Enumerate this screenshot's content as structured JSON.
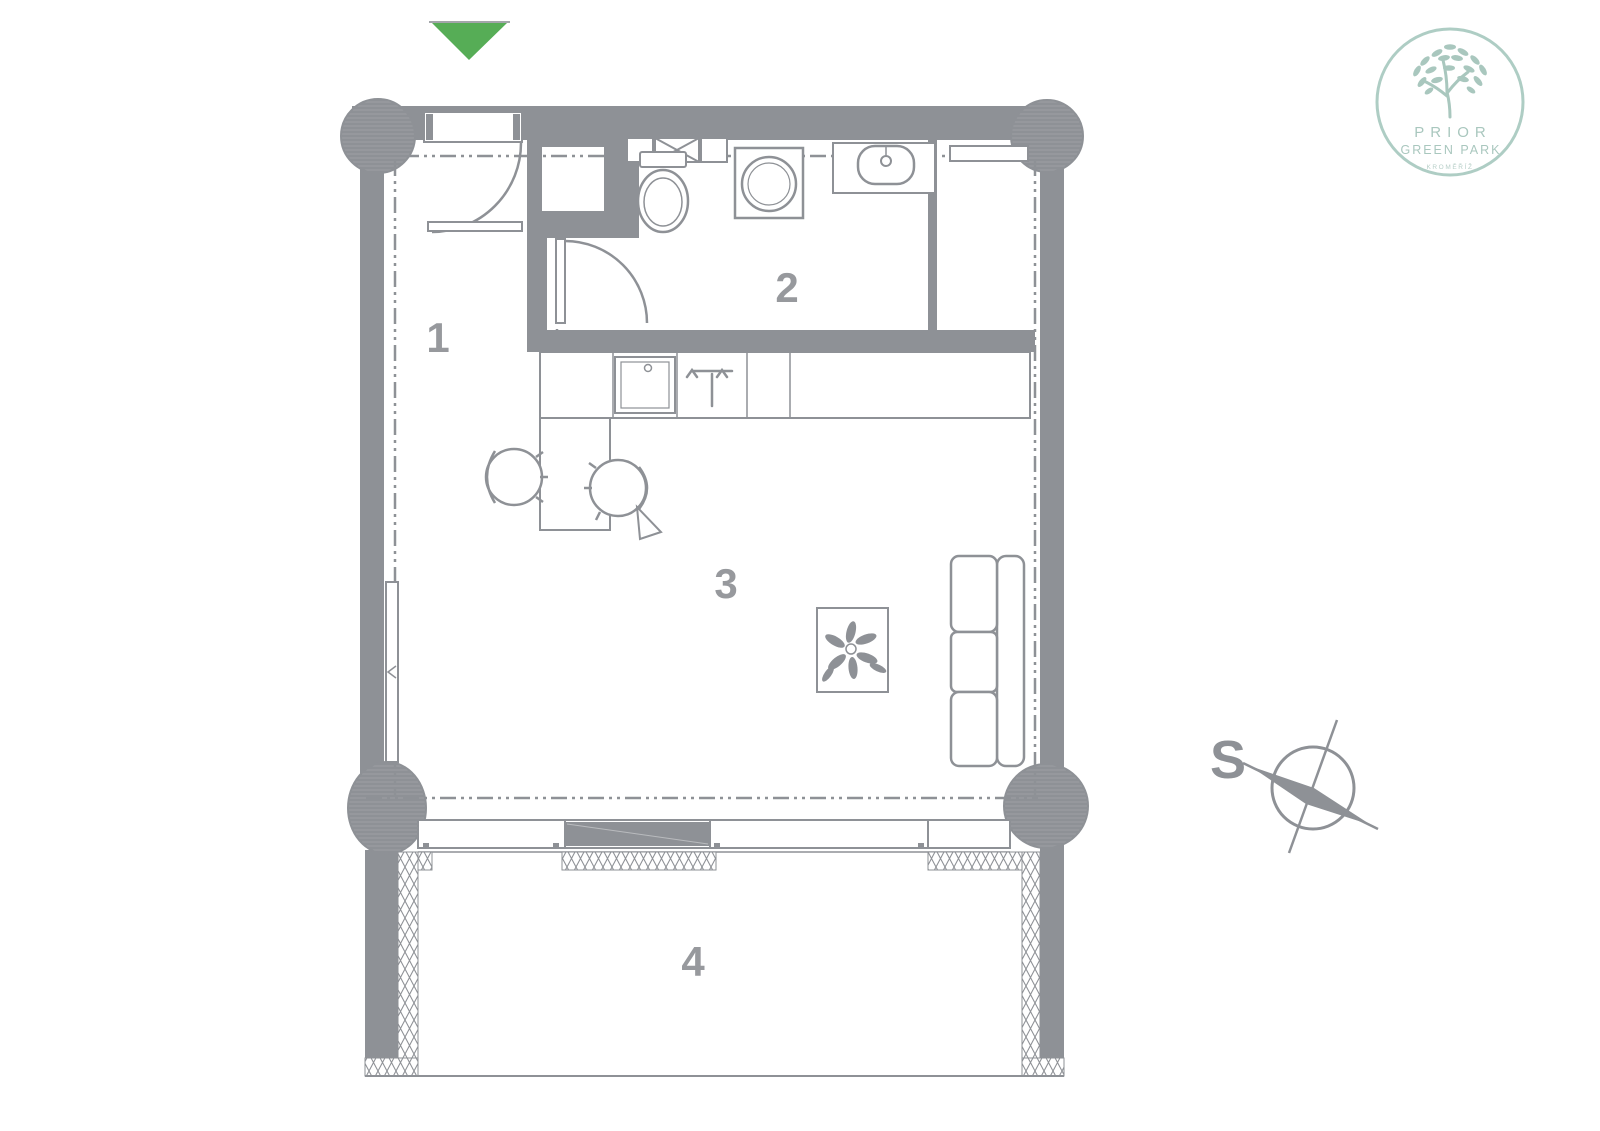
{
  "canvas": {
    "width": 1600,
    "height": 1131,
    "background": "#ffffff"
  },
  "palette": {
    "wall_gray": "#8e9196",
    "line_gray": "#8f9296",
    "light_line": "#aaadb1",
    "label_gray": "#97999d",
    "entrance_green": "#56ad56",
    "logo_green": "#a9c7be"
  },
  "floor_plan": {
    "room_labels": [
      {
        "number": "1"
      },
      {
        "number": "2"
      },
      {
        "number": "3"
      },
      {
        "number": "4"
      }
    ],
    "icons": {
      "entrance_marker": "triangle-down",
      "fixtures": [
        "toilet",
        "washing-machine",
        "bathroom-sink",
        "vent-grille",
        "kitchen-sink",
        "cooktop",
        "dining-table",
        "chair",
        "chair",
        "coffee-table",
        "plant",
        "sofa",
        "radiator",
        "column",
        "sliding-door"
      ]
    }
  },
  "compass": {
    "north_label": "S",
    "icon": "compass-rose"
  },
  "logo": {
    "icon": "tree",
    "title": "PRIOR",
    "subtitle": "GREEN PARK",
    "caption": "KROMĚŘÍŽ"
  }
}
